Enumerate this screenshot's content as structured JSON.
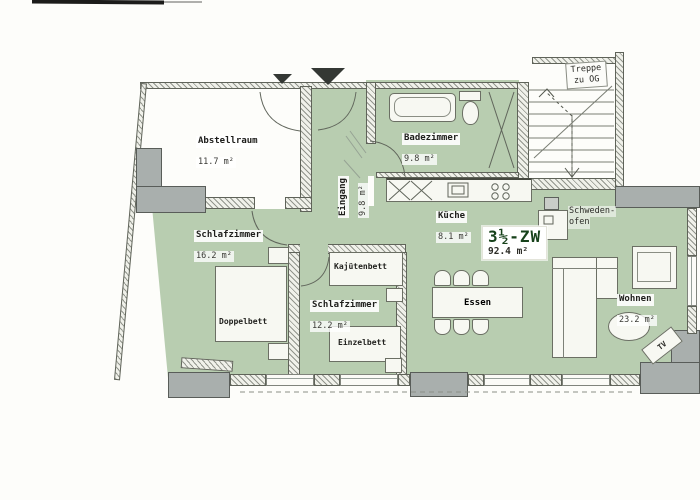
{
  "unit": {
    "name": "3½-ZW",
    "area": "92.4 m²"
  },
  "rooms": {
    "abstellraum": {
      "label": "Abstellraum",
      "area": "11.7 m²"
    },
    "eingang": {
      "label": "Eingang",
      "area": "9.8 m²"
    },
    "badezimmer": {
      "label": "Badezimmer",
      "area": "9.8 m²"
    },
    "kueche": {
      "label": "Küche",
      "area": "8.1 m²"
    },
    "schlafzimmer_gross": {
      "label": "Schlafzimmer",
      "area": "16.2 m²"
    },
    "schlafzimmer_klein": {
      "label": "Schlafzimmer",
      "area": "12.2 m²"
    },
    "essen": {
      "label": "Essen"
    },
    "wohnen": {
      "label": "Wohnen",
      "area": "23.2 m²"
    }
  },
  "furniture": {
    "doppelbett": {
      "label": "Doppelbett"
    },
    "kajuetenbett": {
      "label": "Kajütenbett"
    },
    "einzelbett": {
      "label": "Einzelbett"
    },
    "tv": {
      "label": "TV"
    },
    "schwedenofen": {
      "label_line1": "Schweden-",
      "label_line2": "ofen"
    }
  },
  "stairs": {
    "label_line1": "Treppe",
    "label_line2": "zu OG"
  },
  "colors": {
    "floor_green": "#b8cdb0",
    "wall_gray": "#a9afad",
    "unit_accent": "#17421b"
  }
}
